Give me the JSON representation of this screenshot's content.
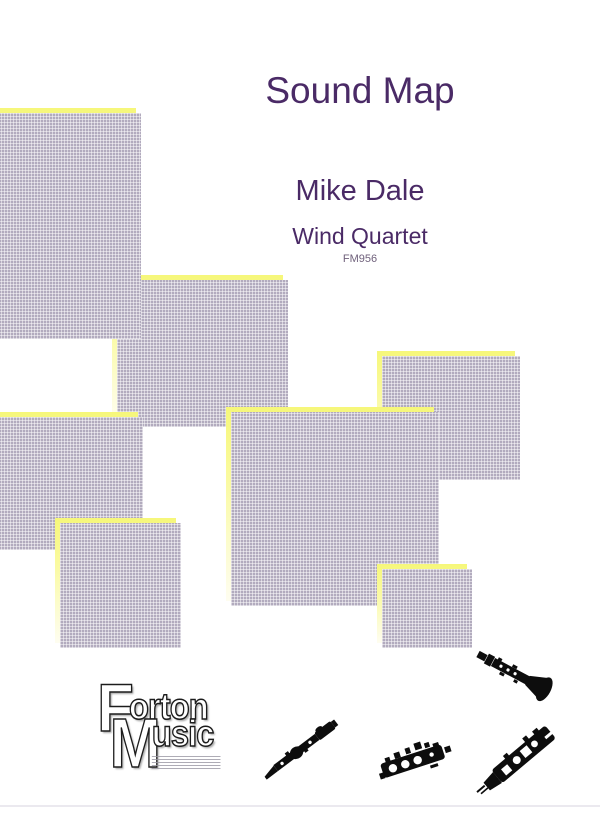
{
  "page": {
    "background": "#ffffff",
    "bottom_rule_color": "#ebe9ef"
  },
  "cover": {
    "title": "Sound Map",
    "composer": "Mike Dale",
    "ensemble": "Wind Quartet",
    "catalog_number": "FM956",
    "title_color": "#4a2a66",
    "catalog_color": "#6f607b"
  },
  "publisher": {
    "name": "Forton Music",
    "logo_line1_initial": "F",
    "logo_line1_rest": "orton",
    "logo_line2_initial": "M",
    "logo_line2_rest": "usic"
  },
  "artwork": {
    "note_color_top": "#f6f77a",
    "note_color_bottom": "#fefdf0",
    "note_shadow_color": "#b2abbe",
    "sticky_notes": [
      {
        "id": "note-b",
        "x": 112,
        "y": 275,
        "w": 171,
        "h": 147,
        "z": 1
      },
      {
        "id": "note-a",
        "x": -88,
        "y": 108,
        "w": 224,
        "h": 226,
        "z": 2
      },
      {
        "id": "note-c",
        "x": -16,
        "y": 412,
        "w": 154,
        "h": 133,
        "z": 3
      },
      {
        "id": "note-d",
        "x": 377,
        "y": 351,
        "w": 138,
        "h": 124,
        "z": 4
      },
      {
        "id": "note-e",
        "x": 226,
        "y": 407,
        "w": 208,
        "h": 194,
        "z": 5
      },
      {
        "id": "note-f",
        "x": 55,
        "y": 518,
        "w": 121,
        "h": 125,
        "z": 6
      },
      {
        "id": "note-g",
        "x": 377,
        "y": 564,
        "w": 90,
        "h": 79,
        "z": 7
      }
    ],
    "instruments": [
      "clarinet-icon",
      "flute-icon",
      "oboe-joint-icon",
      "clarinet-joint-icon"
    ]
  }
}
